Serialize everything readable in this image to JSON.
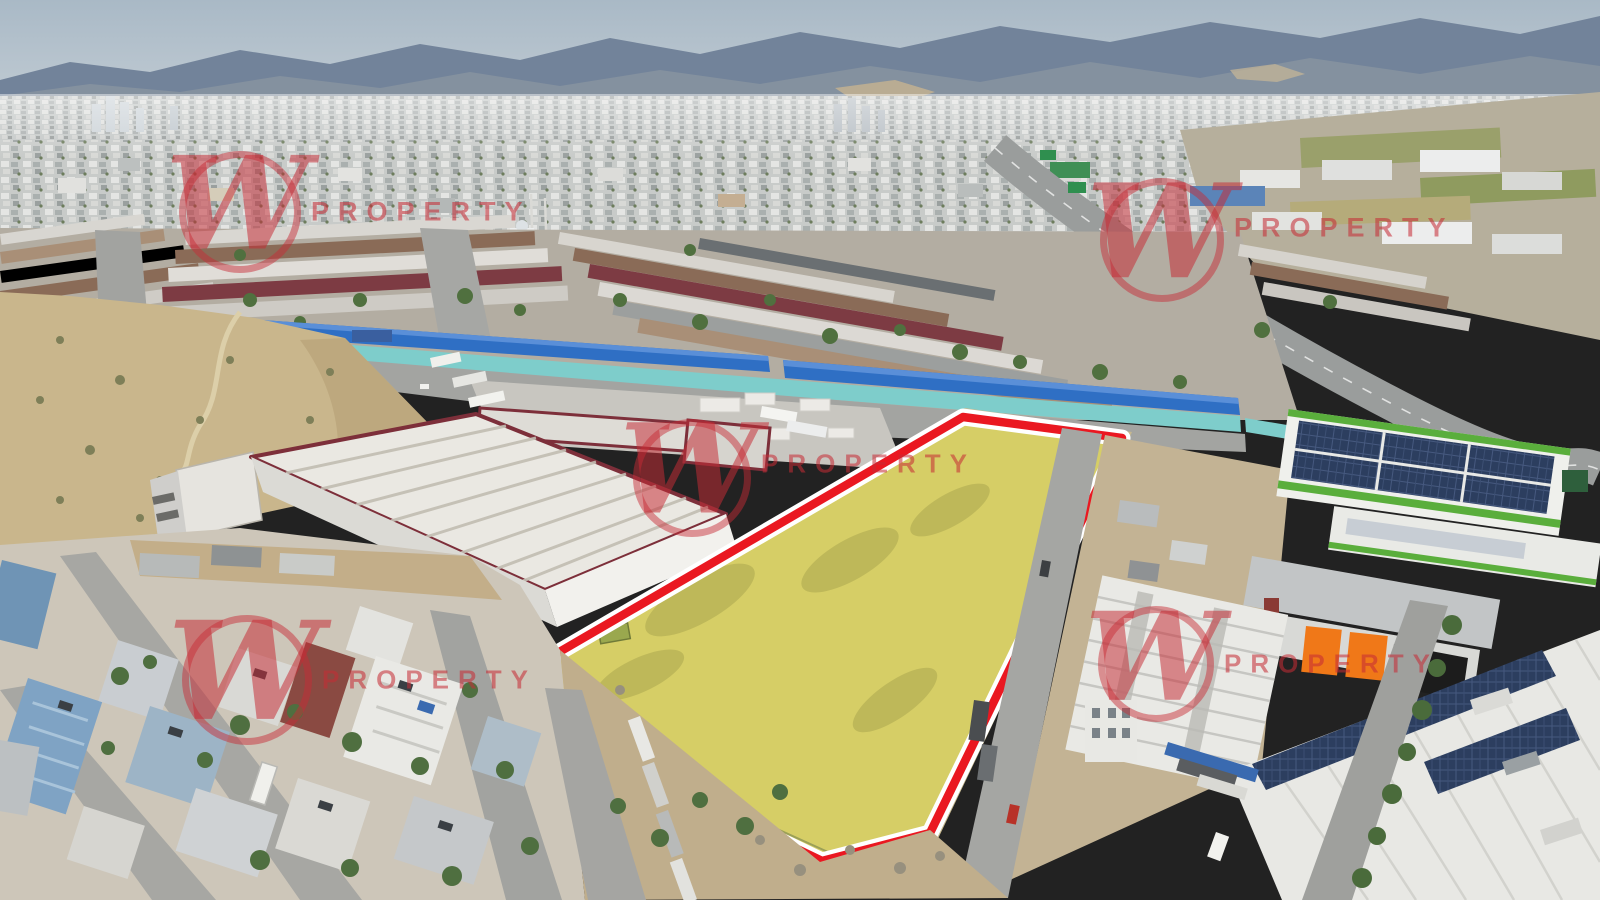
{
  "image": {
    "type": "aerial-drone-photograph",
    "description": "Aerial view of an industrial district and bazaar with a vacant land plot highlighted in yellow with a red outline, residential blocks in the foreground and mountains behind the city skyline",
    "width": 1600,
    "height": 900
  },
  "watermark": {
    "letter": "W",
    "text": "PROPERTY",
    "color": "rgba(198,44,54,0.62)",
    "count": 5
  },
  "plot_highlight": {
    "fill": "#e6e33e",
    "fill_opacity": 0.5,
    "outline_color": "#ea1821",
    "outline_casing": "#ffffff",
    "polygon_str": "482,697 963,417 1122,438 930,833 822,861"
  },
  "scene_colors": {
    "sky_top": "#a9b9c6",
    "sky_bottom": "#c2ccd4",
    "mountains": "#76879b",
    "city": "#c7cac9",
    "bazaar_roof_brown": "#8a6b57",
    "bazaar_roof_maroon": "#7d3b43",
    "market_blue_roof": "#2f6fc4",
    "market_teal_wall": "#7ecdcb",
    "hill_dirt": "#c9b68c",
    "warehouse_trim_maroon": "#7d2f3a",
    "solar_panels": "#2c3e5f",
    "green_building_trim": "#5aae3c",
    "orange_doors": "#f07818",
    "residential_blue": "#7fa3c4",
    "asphalt": "#a5a6a3"
  }
}
